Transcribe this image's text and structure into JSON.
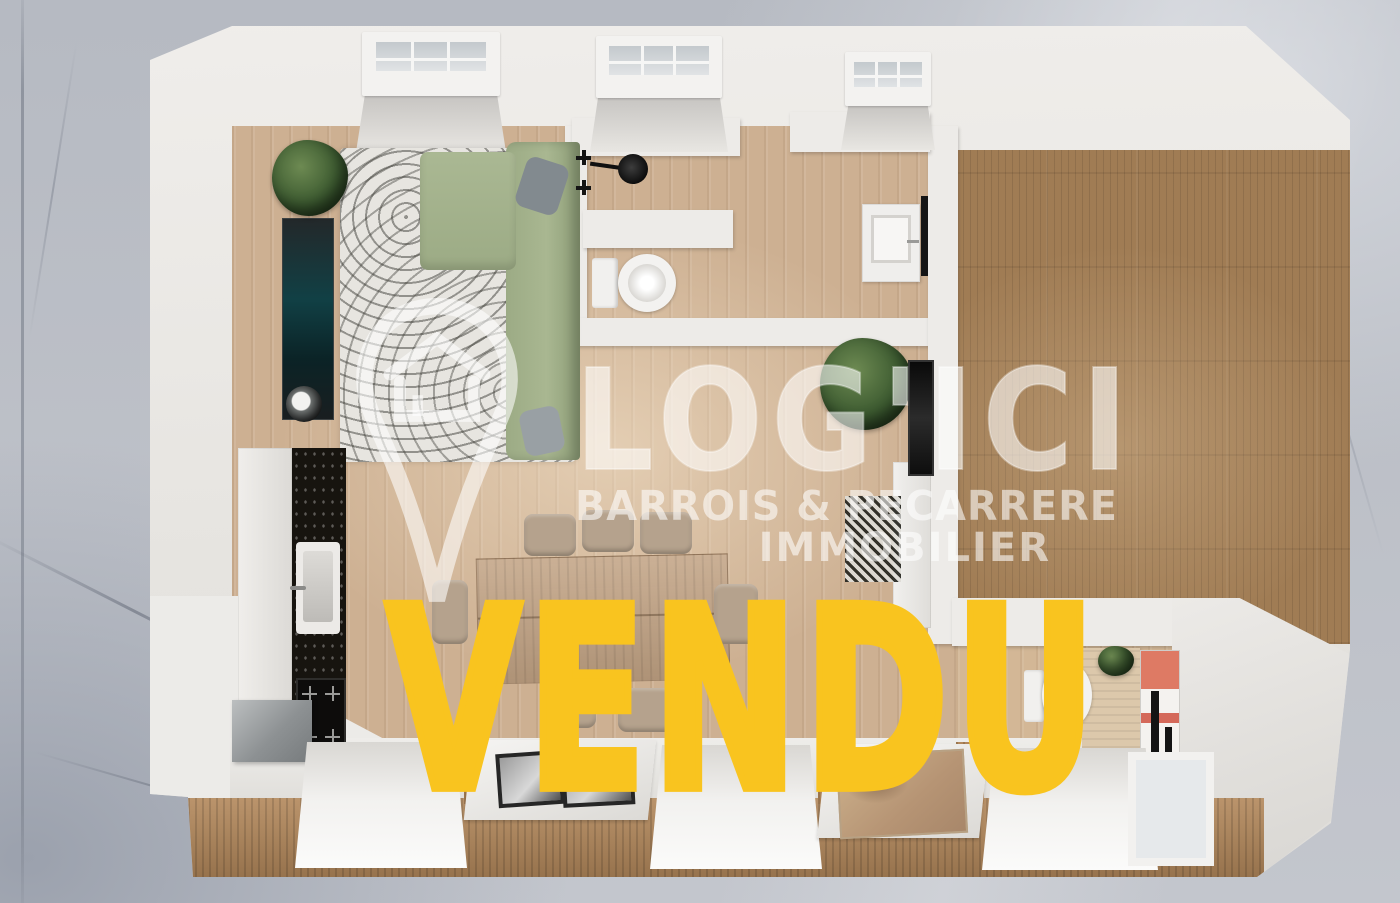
{
  "scene": {
    "type": "3d-floorplan-top-view-render",
    "background_material": "marble",
    "colors": {
      "marble_gray": "#b6bac2",
      "wall_white": "#eae8e4",
      "wood_floor_light": "#cdb092",
      "wood_floor_dark": "#a07c54",
      "wood_facade": "#b3885b",
      "sofa_green": "#a2b18b",
      "counter_black": "#17140f",
      "sold_yellow": "#f9c41f",
      "watermark_white": "rgba(255,255,255,0.58)"
    },
    "icons": {
      "brand_pin": "map-pin-house-icon"
    }
  },
  "watermark": {
    "brand": "LOG'ICI",
    "tagline_line1": "BARROIS & PECARRERE",
    "tagline_line2": "IMMOBILIER"
  },
  "overlay": {
    "sold_label": "VENDU"
  }
}
